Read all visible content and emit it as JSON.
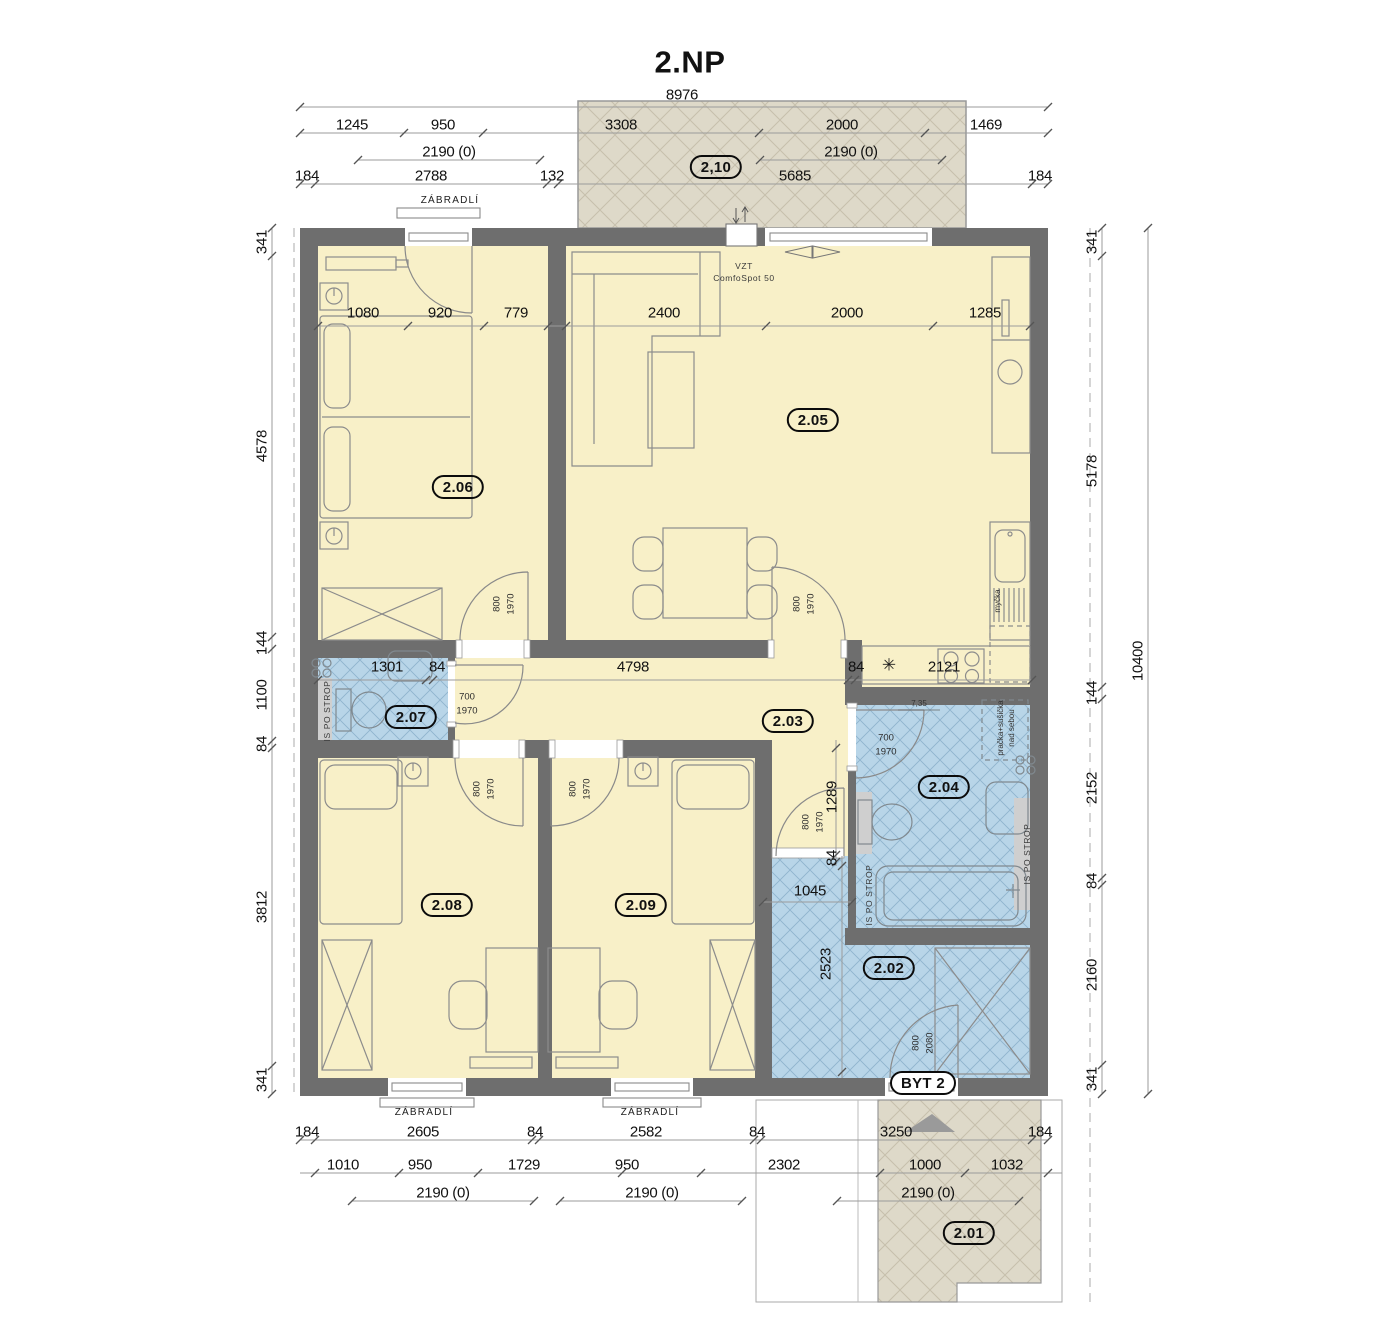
{
  "title": "2.NP",
  "colors": {
    "wall": "#6E6E6E",
    "room_yellow": "#F8F0C8",
    "wet_room_blue": "#B8D5E8",
    "blue_hatch": "#8FB4CE",
    "outdoor_beige": "#DED9C9",
    "beige_hatch": "#C6BFAC",
    "furniture_line": "#8C8C8C",
    "dim_line": "#9B9B9B",
    "text": "#111111"
  },
  "room_labels": [
    {
      "t": "2,10",
      "x": 716,
      "y": 167
    },
    {
      "t": "2.05",
      "x": 813,
      "y": 420
    },
    {
      "t": "2.06",
      "x": 458,
      "y": 487
    },
    {
      "t": "2.07",
      "x": 411,
      "y": 717
    },
    {
      "t": "2.03",
      "x": 788,
      "y": 721
    },
    {
      "t": "2.04",
      "x": 944,
      "y": 787
    },
    {
      "t": "2.08",
      "x": 447,
      "y": 905
    },
    {
      "t": "2.09",
      "x": 641,
      "y": 905
    },
    {
      "t": "2.02",
      "x": 889,
      "y": 968
    },
    {
      "t": "BYT 2",
      "x": 923,
      "y": 1083,
      "c": "byt",
      "n": "entrance-unit-label"
    },
    {
      "t": "2.01",
      "x": 969,
      "y": 1233
    }
  ],
  "dim_labels": [
    {
      "t": "8976",
      "x": 682,
      "y": 95
    },
    {
      "t": "1245",
      "x": 352,
      "y": 125
    },
    {
      "t": "950",
      "x": 443,
      "y": 125
    },
    {
      "t": "3308",
      "x": 621,
      "y": 125
    },
    {
      "t": "2000",
      "x": 842,
      "y": 125
    },
    {
      "t": "1469",
      "x": 986,
      "y": 125
    },
    {
      "t": "2190 (0)",
      "x": 449,
      "y": 152
    },
    {
      "t": "2190 (0)",
      "x": 851,
      "y": 152
    },
    {
      "t": "184",
      "x": 307,
      "y": 176
    },
    {
      "t": "2788",
      "x": 431,
      "y": 176
    },
    {
      "t": "132",
      "x": 552,
      "y": 176
    },
    {
      "t": "5685",
      "x": 795,
      "y": 176
    },
    {
      "t": "184",
      "x": 1040,
      "y": 176
    },
    {
      "t": "341",
      "x": 262,
      "y": 242,
      "r": -90
    },
    {
      "t": "4578",
      "x": 262,
      "y": 446,
      "r": -90
    },
    {
      "t": "144",
      "x": 262,
      "y": 643,
      "r": -90
    },
    {
      "t": "1100",
      "x": 262,
      "y": 695,
      "r": -90
    },
    {
      "t": "84",
      "x": 262,
      "y": 744,
      "r": -90
    },
    {
      "t": "3812",
      "x": 262,
      "y": 907,
      "r": -90
    },
    {
      "t": "341",
      "x": 262,
      "y": 1080,
      "r": -90
    },
    {
      "t": "341",
      "x": 1092,
      "y": 242,
      "r": -90
    },
    {
      "t": "5178",
      "x": 1092,
      "y": 471,
      "r": -90
    },
    {
      "t": "144",
      "x": 1092,
      "y": 693,
      "r": -90
    },
    {
      "t": "2152",
      "x": 1092,
      "y": 788,
      "r": -90
    },
    {
      "t": "84",
      "x": 1092,
      "y": 881,
      "r": -90
    },
    {
      "t": "2160",
      "x": 1092,
      "y": 975,
      "r": -90
    },
    {
      "t": "341",
      "x": 1092,
      "y": 1079,
      "r": -90
    },
    {
      "t": "10400",
      "x": 1138,
      "y": 661,
      "r": -90
    },
    {
      "t": "184",
      "x": 307,
      "y": 1132
    },
    {
      "t": "2605",
      "x": 423,
      "y": 1132
    },
    {
      "t": "84",
      "x": 535,
      "y": 1132
    },
    {
      "t": "2582",
      "x": 646,
      "y": 1132
    },
    {
      "t": "84",
      "x": 757,
      "y": 1132
    },
    {
      "t": "3250",
      "x": 896,
      "y": 1132
    },
    {
      "t": "184",
      "x": 1040,
      "y": 1132
    },
    {
      "t": "1010",
      "x": 343,
      "y": 1165
    },
    {
      "t": "950",
      "x": 420,
      "y": 1165
    },
    {
      "t": "1729",
      "x": 524,
      "y": 1165
    },
    {
      "t": "950",
      "x": 627,
      "y": 1165
    },
    {
      "t": "2302",
      "x": 784,
      "y": 1165
    },
    {
      "t": "1000",
      "x": 925,
      "y": 1165
    },
    {
      "t": "1032",
      "x": 1007,
      "y": 1165
    },
    {
      "t": "2190 (0)",
      "x": 443,
      "y": 1193
    },
    {
      "t": "2190 (0)",
      "x": 652,
      "y": 1193
    },
    {
      "t": "2190 (0)",
      "x": 928,
      "y": 1193
    },
    {
      "t": "1080",
      "x": 363,
      "y": 313
    },
    {
      "t": "920",
      "x": 440,
      "y": 313
    },
    {
      "t": "779",
      "x": 516,
      "y": 313
    },
    {
      "t": "2400",
      "x": 664,
      "y": 313
    },
    {
      "t": "2000",
      "x": 847,
      "y": 313
    },
    {
      "t": "1285",
      "x": 985,
      "y": 313
    },
    {
      "t": "1301",
      "x": 387,
      "y": 667
    },
    {
      "t": "84",
      "x": 437,
      "y": 667
    },
    {
      "t": "4798",
      "x": 633,
      "y": 667
    },
    {
      "t": "84",
      "x": 856,
      "y": 667
    },
    {
      "t": "2121",
      "x": 944,
      "y": 667
    },
    {
      "t": "1289",
      "x": 832,
      "y": 797,
      "r": -90
    },
    {
      "t": "84",
      "x": 832,
      "y": 858,
      "r": -90
    },
    {
      "t": "1045",
      "x": 810,
      "y": 891
    },
    {
      "t": "2523",
      "x": 826,
      "y": 964,
      "r": -90
    }
  ],
  "door_labels": [
    {
      "t": "800",
      "x": 497,
      "y": 604,
      "r": -90
    },
    {
      "t": "1970",
      "x": 511,
      "y": 604,
      "r": -90
    },
    {
      "t": "800",
      "x": 797,
      "y": 604,
      "r": -90
    },
    {
      "t": "1970",
      "x": 811,
      "y": 604,
      "r": -90
    },
    {
      "t": "700",
      "x": 467,
      "y": 697
    },
    {
      "t": "1970",
      "x": 467,
      "y": 711
    },
    {
      "t": "700",
      "x": 886,
      "y": 738
    },
    {
      "t": "1970",
      "x": 886,
      "y": 752
    },
    {
      "t": "800",
      "x": 477,
      "y": 789,
      "r": -90
    },
    {
      "t": "1970",
      "x": 491,
      "y": 789,
      "r": -90
    },
    {
      "t": "800",
      "x": 573,
      "y": 789,
      "r": -90
    },
    {
      "t": "1970",
      "x": 587,
      "y": 789,
      "r": -90
    },
    {
      "t": "800",
      "x": 806,
      "y": 822,
      "r": -90
    },
    {
      "t": "1970",
      "x": 820,
      "y": 822,
      "r": -90
    },
    {
      "t": "800",
      "x": 916,
      "y": 1043,
      "r": -90
    },
    {
      "t": "2080",
      "x": 930,
      "y": 1043,
      "r": -90
    }
  ],
  "annotations": [
    {
      "t": "ZÁBRADLÍ",
      "x": 450,
      "y": 201,
      "n": "railing-label"
    },
    {
      "t": "ZÁBRADLÍ",
      "x": 424,
      "y": 1113,
      "n": "railing-label"
    },
    {
      "t": "ZÁBRADLÍ",
      "x": 650,
      "y": 1113,
      "n": "railing-label"
    },
    {
      "t": "VZT",
      "x": 744,
      "y": 266,
      "c": "strop",
      "n": "ventilation-label"
    },
    {
      "t": "ComfoSpot 50",
      "x": 744,
      "y": 278,
      "c": "strop",
      "n": "ventilation-label"
    },
    {
      "t": "IS PO STROP",
      "x": 327,
      "y": 711,
      "r": -90,
      "c": "strop",
      "n": "shaft-label"
    },
    {
      "t": "IS PO STROP",
      "x": 869,
      "y": 895,
      "r": -90,
      "c": "strop",
      "n": "shaft-label"
    },
    {
      "t": "IS PO STROP",
      "x": 1027,
      "y": 854,
      "r": -90,
      "c": "strop",
      "n": "shaft-label"
    },
    {
      "t": "pračka+sušička",
      "x": 1001,
      "y": 728,
      "r": -90,
      "c": "tiny",
      "n": "washer-dryer-label"
    },
    {
      "t": "nad sebou",
      "x": 1012,
      "y": 728,
      "r": -90,
      "c": "tiny",
      "n": "washer-dryer-label"
    },
    {
      "t": "myčka",
      "x": 998,
      "y": 601,
      "r": -90,
      "c": "tiny",
      "n": "dishwasher-label"
    },
    {
      "t": "7,35",
      "x": 919,
      "y": 704,
      "c": "tiny",
      "n": "level-label"
    },
    {
      "t": "✳",
      "x": 889,
      "y": 665,
      "c": "snow",
      "n": "snowflake-symbol"
    }
  ],
  "dim_lines": {
    "h": [
      {
        "y": 107,
        "x1": 300,
        "x2": 1048,
        "t": [
          300,
          1048
        ]
      },
      {
        "y": 133,
        "x1": 300,
        "x2": 1048,
        "t": [
          300,
          404,
          483,
          759,
          925,
          1048
        ]
      },
      {
        "y": 160,
        "x1": 358,
        "x2": 540,
        "t": [
          358,
          540
        ]
      },
      {
        "y": 160,
        "x1": 760,
        "x2": 942,
        "t": [
          760,
          942
        ]
      },
      {
        "y": 184,
        "x1": 300,
        "x2": 1048,
        "t": [
          300,
          315,
          547,
          558,
          1032,
          1048
        ]
      },
      {
        "y": 326,
        "x1": 318,
        "x2": 1030,
        "t": [
          318,
          408,
          484,
          548,
          566,
          766,
          933,
          1030
        ]
      },
      {
        "y": 680,
        "x1": 318,
        "x2": 1032,
        "t": [
          318,
          426,
          433,
          848,
          855,
          1032
        ]
      },
      {
        "y": 902,
        "x1": 763,
        "x2": 852,
        "t": [
          763,
          852
        ]
      },
      {
        "y": 1140,
        "x1": 300,
        "x2": 1048,
        "t": [
          300,
          315,
          532,
          539,
          754,
          761,
          1032,
          1048
        ]
      },
      {
        "y": 1173,
        "x1": 300,
        "x2": 1062,
        "t": [
          315,
          399,
          478,
          622,
          701,
          880,
          965,
          1048
        ]
      },
      {
        "y": 1201,
        "x1": 352,
        "x2": 534,
        "t": [
          352,
          534
        ]
      },
      {
        "y": 1201,
        "x1": 560,
        "x2": 742,
        "t": [
          560,
          742
        ]
      },
      {
        "y": 1201,
        "x1": 837,
        "x2": 1019,
        "t": [
          837,
          1019
        ]
      }
    ],
    "v": [
      {
        "x": 272,
        "y1": 228,
        "y2": 1094,
        "t": [
          228,
          256,
          637,
          649,
          741,
          748,
          1066,
          1094
        ]
      },
      {
        "x": 1102,
        "y1": 228,
        "y2": 1094,
        "t": [
          228,
          256,
          687,
          699,
          878,
          885,
          1065,
          1094
        ]
      },
      {
        "x": 1148,
        "y1": 228,
        "y2": 1094,
        "t": [
          228,
          1094
        ]
      },
      {
        "x": 836,
        "y1": 740,
        "y2": 866,
        "t": [
          748,
          855,
          862
        ]
      },
      {
        "x": 842,
        "y1": 856,
        "y2": 1078,
        "t": [
          866,
          1072
        ]
      }
    ]
  }
}
